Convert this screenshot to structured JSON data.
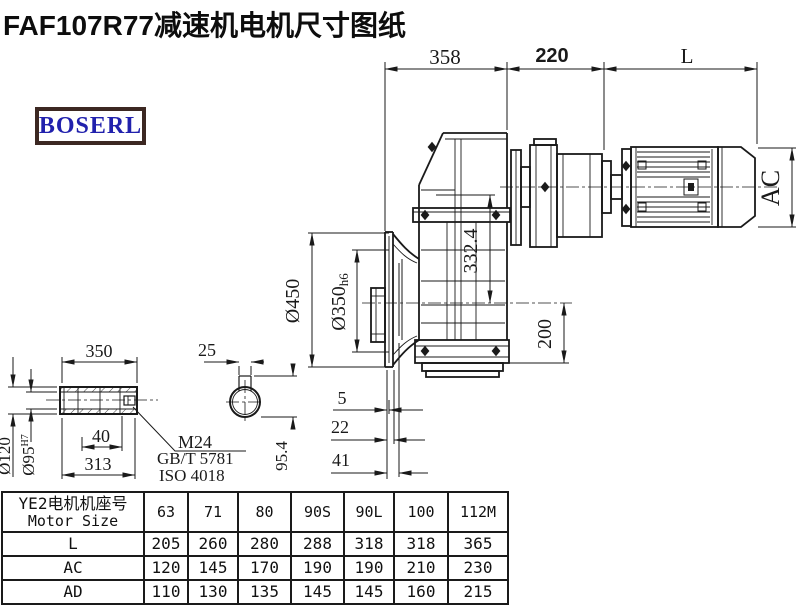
{
  "title": "FAF107R77减速机电机尺寸图纸",
  "logo": {
    "text": "BOSERL",
    "border_color": "#3c2822",
    "text_color": "#2121ad"
  },
  "drawing": {
    "dims": {
      "top_358": "358",
      "top_220": "220",
      "top_L": "L",
      "ac": "AC",
      "v332": "332.4",
      "v200": "200",
      "d450": "Ø450",
      "d350": "Ø350",
      "d350_suffix": "h6",
      "s5": "5",
      "s22": "22",
      "s41": "41",
      "shaft_350": "350",
      "shaft_40": "40",
      "shaft_313": "313",
      "d120": "Ø120",
      "d95": "Ø95",
      "d95_sup": "H7",
      "key_25": "25",
      "key_954": "95.4",
      "thread": "M24",
      "standard_gb": "GB/T 5781",
      "standard_iso": "ISO 4018"
    }
  },
  "table": {
    "header_cn": "YE2电机机座号",
    "header_en": "Motor Size",
    "columns": [
      "63",
      "71",
      "80",
      "90S",
      "90L",
      "100",
      "112M"
    ],
    "rows": [
      {
        "label": "L",
        "values": [
          "205",
          "260",
          "280",
          "288",
          "318",
          "318",
          "365"
        ]
      },
      {
        "label": "AC",
        "values": [
          "120",
          "145",
          "170",
          "190",
          "190",
          "210",
          "230"
        ]
      },
      {
        "label": "AD",
        "values": [
          "110",
          "130",
          "135",
          "145",
          "145",
          "160",
          "215"
        ]
      }
    ]
  }
}
